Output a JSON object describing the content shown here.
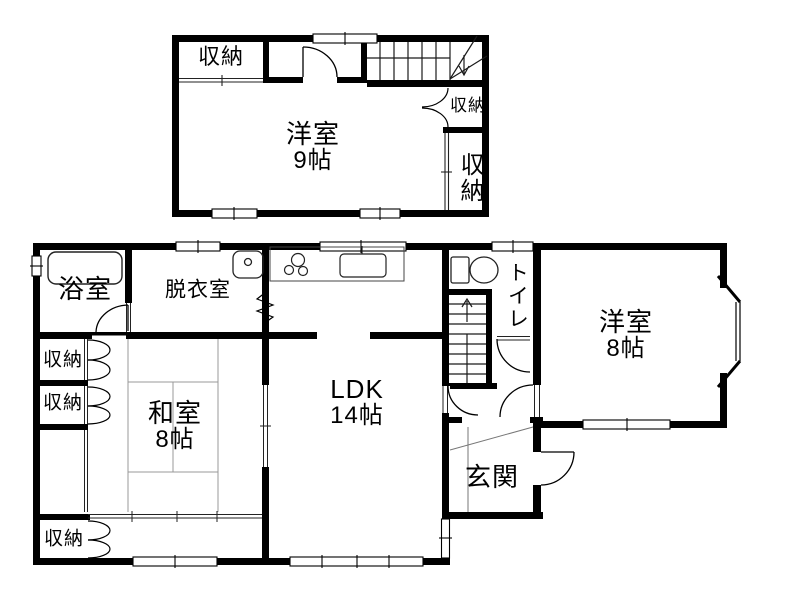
{
  "second_floor": {
    "storage_top_left": "収納",
    "western_room": "洋室",
    "western_room_size": "9帖",
    "storage_middle": "収納",
    "storage_bottom_right": "収納"
  },
  "first_floor": {
    "bathroom": "浴室",
    "dressing_room": "脱衣室",
    "storage_upper": "収納",
    "storage_lower": "収納",
    "japanese_room": "和室",
    "japanese_room_size": "8帖",
    "ldk": "LDK",
    "ldk_size": "14帖",
    "entrance": "玄関",
    "toilet": "トイレ",
    "western_room": "洋室",
    "western_room_size": "8帖",
    "storage_veranda": "収納"
  },
  "colors": {
    "wall": "#000000",
    "background": "#ffffff",
    "tatami_line": "#999999",
    "fixture_line": "#222222"
  }
}
